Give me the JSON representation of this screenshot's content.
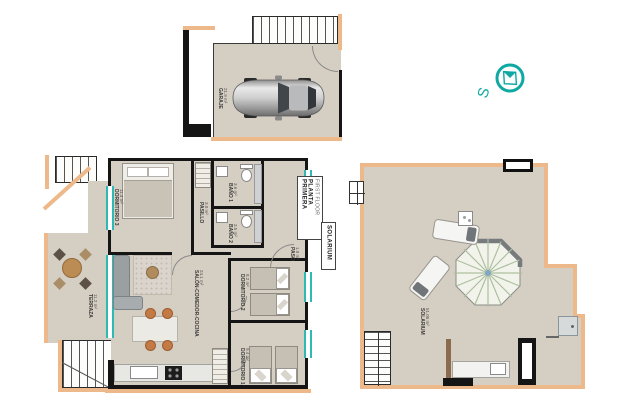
{
  "compass": {
    "south": "S"
  },
  "garage": {
    "name": "GARAJE",
    "area": "21.9 m²"
  },
  "first_floor": {
    "title": "PLANTA PRIMERA",
    "subtitle": "FIRST FLOOR",
    "rooms": {
      "bedroom3": {
        "name": "DORMITORIO 3",
        "area": "11.4 m²"
      },
      "bath1": {
        "name": "BAÑO 1",
        "area": "3.6 m²"
      },
      "bath2": {
        "name": "BAÑO 2",
        "area": "3.5 m²"
      },
      "hallway": {
        "name": "PASILLO",
        "area": "3.0 m²"
      },
      "entry": {
        "name": "PASO",
        "area": "1.9 m²"
      },
      "living": {
        "name": "SALÓN-COMEDOR-COCINA",
        "area": "24.1 m²"
      },
      "terrace": {
        "name": "TERRAZA",
        "area": "11.2 m²"
      },
      "bedroom2": {
        "name": "DORMITORIO 2",
        "area": "8.2 m²"
      },
      "bedroom1": {
        "name": "DORMITORIO 1",
        "area": "9.4 m²"
      }
    }
  },
  "solarium": {
    "title": "SOLARIUM",
    "name": "SOLARIUM",
    "area": "51.05 m²"
  },
  "colors": {
    "teal": "#0fa8a2",
    "trim": "#edb98a",
    "wall": "#151515",
    "floor": "#d5cec3"
  }
}
